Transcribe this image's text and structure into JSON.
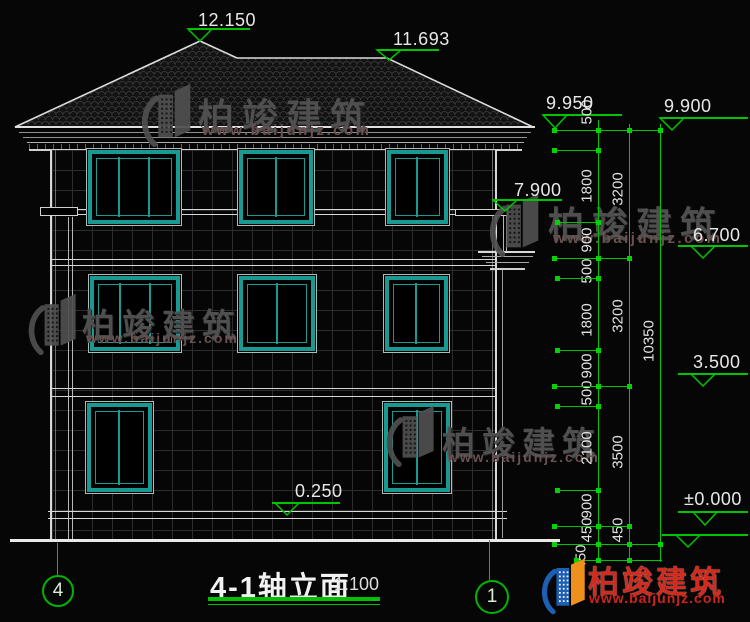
{
  "brand": {
    "name": "柏竣建筑",
    "url": "www.baijunjz.com"
  },
  "title_block": {
    "title": "4-1轴立面",
    "scale": "1:100"
  },
  "axis_bubbles": {
    "left": "4",
    "right": "1"
  },
  "elevations": {
    "ridge_main": "12.150",
    "ridge_secondary": "11.693",
    "eave_top": "9.950",
    "roof_slab": "9.900",
    "wing_roof": "7.900",
    "floor3": "6.700",
    "floor2": "3.500",
    "ground_floor": "±0.000",
    "porch_floor": "0.250"
  },
  "dimensions": {
    "col1": [
      "500",
      "1800",
      "900",
      "500",
      "1800",
      "900",
      "500",
      "2100",
      "900",
      "450"
    ],
    "col1_extra": "450",
    "col2": [
      "3200",
      "3200",
      "3500",
      "450"
    ],
    "col3": [
      "10350"
    ]
  },
  "colors": {
    "dim_green": "#00c400",
    "window_teal": "#189a93",
    "watermark_gray": "#4f4f4f",
    "logo_red": "#d42a1e",
    "logo_blue": "#1d5fb2",
    "logo_orange": "#ef8f1c"
  }
}
